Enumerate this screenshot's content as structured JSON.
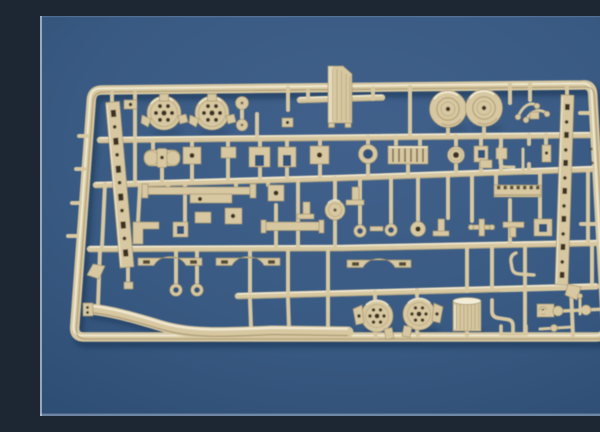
{
  "image": {
    "type": "photograph",
    "subject": "Injection-moulded scale model kit sprue (parts tree)",
    "description": "Overhead photograph of a single tan/beige plastic model-kit sprue densely packed with small unassembled parts - brake drums, road wheels, ladder rails, axle housings, brackets, leaf-spring arches, washers, a toothed rack, bent pipes, two blower drums, a ribbed drum and a long curved fender strip - lying on a plain blue backdrop",
    "visible_text": "none"
  },
  "colors": {
    "background-center": "#41618c",
    "background-mid": "#395a82",
    "background-edge": "#2e4d75",
    "tan": "#d7c8a1",
    "tan-light": "#f3ecd7",
    "tan-dark": "#a3926c",
    "hole": "#3e3220",
    "hole-blue": "#33527b",
    "shadow": "#16304f",
    "edge-light": "#cdd8e6"
  },
  "sprue": {
    "material": "tan plastic",
    "backdrop": "blue surface",
    "part_types": [
      "brake drums",
      "road wheels",
      "perforated ladder rails",
      "axle housing",
      "U-brackets",
      "radiator block",
      "tube ring",
      "leaf-spring arches",
      "long axle bars",
      "washers and rings",
      "center disc",
      "toothed rack",
      "bent pipes and rods",
      "curved fender strip",
      "blower drums",
      "ribbed drum",
      "axle rods with discs",
      "small brackets and blocks"
    ]
  }
}
